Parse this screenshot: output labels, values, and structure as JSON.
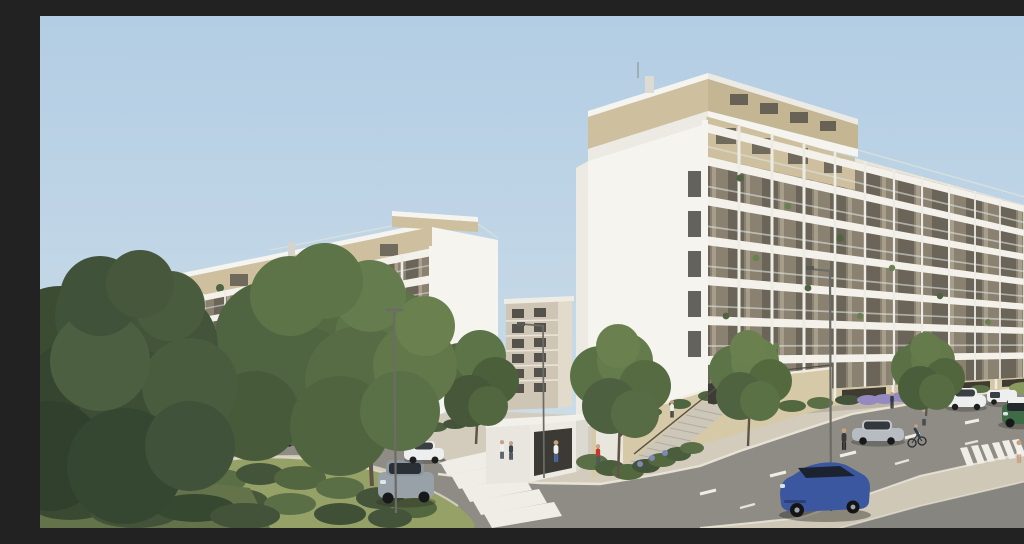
{
  "meta": {
    "title": "New-build residential complex — exterior street rendering",
    "description": "Photorealistic architectural 3D visualization: two white mid-rise apartment blocks with stacked balcony grids and beige stone attic levels, a curving local street with angled parking around a planted island, a main avenue with dashed lane markings, zebra crossings, street lamps, parked and moving cars, pedestrians, cyclists and young street trees under a clear pale-blue sky.",
    "canvas": {
      "width": 1024,
      "height": 512
    },
    "time_of_day": "day, clear sky",
    "style": "photorealistic CGI exterior view"
  },
  "palette": {
    "sky_top": "#b3cde4",
    "sky_horizon": "#dbe5e4",
    "white_sunlit": "#f5f4ef",
    "white_mid": "#eceae3",
    "white_shade": "#dedbd2",
    "slab_white": "#f3f1ea",
    "pillar_white": "#ecebe4",
    "recess_tan": "#8a8171",
    "recess_dark": "#57524a",
    "glass_dark": "#494741",
    "stone_attic": "#cec09f",
    "stone_base": "#d3c7a4",
    "stone_wall": "#d6c9a8",
    "railing_glass": "#dce3dc",
    "road": "#8e8c85",
    "median": "#cfc8b7",
    "sidewalk": "#d3ccbc",
    "kerb": "#eae5d8",
    "marking": "#efede5",
    "grass": "#96a168",
    "grass_shade": "#64734a",
    "bush_dark": "#44543a",
    "bush_mid": "#5a6f45",
    "leaf_dark": "#3c4c32",
    "leaf_mid": "#4f6440",
    "leaf_light": "#69804f",
    "distant_green": "#74855c",
    "lavender": "#9589c0",
    "flower_blue": "#7f86b8",
    "trunk": "#5f5546",
    "lamp": "#6c6c66",
    "umbrella": "#d9c298",
    "car_white": "#edefee",
    "car_black": "#33353a",
    "car_gray": "#4e5256",
    "car_silver": "#b6bcc1",
    "car_steel": "#99a1a8",
    "car_blue": "#3a57a0",
    "car_green": "#3f6b46",
    "skin": "#c8a084"
  },
  "scene": {
    "sky": {
      "condition": "clear",
      "gradient": [
        "sky_top",
        "sky_horizon"
      ]
    },
    "buildings": [
      {
        "id": "left-apartment-block",
        "floors_visible": 7,
        "penthouse": "recessed beige stone attic level with roof-terrace glass railing and planting",
        "facade": "white concrete balcony grid, glass balustrades, planted balconies",
        "ground_floor": "full-height dark glazing between white piers",
        "orientation": "long facade receding toward the left, white gable end at right"
      },
      {
        "id": "right-apartment-block",
        "floors_visible": 8,
        "penthouse": "beige travertine attic band with clerestory windows",
        "facade": "white balcony grid with glass balustrades and balcony planting, receding to the right",
        "gable": "large blank white end wall with slot windows at the corner",
        "base": "travertine stone plinth with dark glazed openings"
      },
      {
        "id": "background-tower",
        "floors_visible": 7,
        "facade": "beige facade with dark window grid, seen in the gap between the two main blocks"
      }
    ],
    "street": {
      "roads": [
        {
          "id": "main-avenue",
          "markings": "white dashed lane lines",
          "median": "paved median strip with second carriageway at corner"
        },
        {
          "id": "local-loop-street",
          "feature": "curves around a planted island, parallel parking along the kerb"
        }
      ],
      "crosswalks": 2,
      "street_lamps": 4,
      "landscaping": [
        "two mature foreground trees",
        "planted traffic island with shrubs",
        "young street trees",
        "lavender beds",
        "flowering groundcover at the corner"
      ]
    },
    "structures": [
      {
        "id": "garage-kiosk",
        "desc": "small flat-roofed white utility building with dark opening"
      },
      {
        "id": "entrance-stairs",
        "desc": "stone-flanked exterior stair with metal handrail up to the podium entrance"
      },
      {
        "id": "retaining-wall",
        "desc": "travertine planter wall with overhanging greenery"
      },
      {
        "id": "parasol",
        "desc": "beige patio umbrella on the podium terrace"
      }
    ],
    "vehicles": [
      {
        "id": "hatchback-far-left",
        "type": "hatchback",
        "color": "#edefee",
        "color_name": "white",
        "state": "parked"
      },
      {
        "id": "sedan-behind-tree",
        "type": "sedan",
        "color": "#33353a",
        "color_name": "black",
        "state": "parked"
      },
      {
        "id": "hatchback-left-1",
        "type": "hatchback",
        "color": "#edefee",
        "color_name": "white",
        "state": "parked"
      },
      {
        "id": "suv-left-black",
        "type": "SUV",
        "color": "#33353a",
        "color_name": "black",
        "state": "parked"
      },
      {
        "id": "hatchback-left-2",
        "type": "hatchback",
        "color": "#edefee",
        "color_name": "white",
        "state": "parked"
      },
      {
        "id": "estate-left-gray",
        "type": "estate",
        "color": "#4e5256",
        "color_name": "dark gray",
        "state": "parked"
      },
      {
        "id": "hatchback-driving-silver",
        "type": "hatchback",
        "color": "#99a1a8",
        "color_name": "silver gray",
        "state": "driving"
      },
      {
        "id": "hatchback-crosswalk-white",
        "type": "hatchback",
        "color": "#edefee",
        "color_name": "white",
        "state": "parked"
      },
      {
        "id": "sedan-right-silver",
        "type": "sedan",
        "color": "#b6bcc1",
        "color_name": "silver",
        "state": "parked"
      },
      {
        "id": "suv-right-white",
        "type": "SUV",
        "color": "#edefee",
        "color_name": "white",
        "state": "parked"
      },
      {
        "id": "van-right-white",
        "type": "van",
        "color": "#edefee",
        "color_name": "white",
        "state": "parked"
      },
      {
        "id": "crossover-green",
        "type": "compact crossover",
        "color": "#3f6b46",
        "color_name": "green with white roof",
        "state": "driving"
      },
      {
        "id": "suv-coupe-blue",
        "type": "SUV coupe",
        "color": "#3a57a0",
        "color_name": "blue",
        "state": "driving"
      }
    ],
    "people": [
      {
        "id": "cyclist-island",
        "activity": "cycling around the island bend"
      },
      {
        "id": "cyclist-avenue",
        "activity": "cycling near the avenue crossing"
      },
      {
        "id": "walker-pair-a",
        "activity": "walking along the left block",
        "clothing": "white top"
      },
      {
        "id": "walker-pair-b",
        "activity": "walking along the left block",
        "clothing": "dark top"
      },
      {
        "id": "man-white-shirt",
        "activity": "strolling on the corner pavement",
        "clothing": "white shirt, jeans"
      },
      {
        "id": "person-on-stairs",
        "activity": "climbing the entrance stairs",
        "clothing": "white top, dark shorts"
      },
      {
        "id": "person-red-top",
        "activity": "standing by the planting",
        "clothing": "red top"
      },
      {
        "id": "walker-dark",
        "activity": "crossing the avenue edge",
        "clothing": "dark outfit"
      },
      {
        "id": "walker-gray",
        "activity": "walking on the avenue pavement",
        "clothing": "gray top"
      },
      {
        "id": "woman-white-dress",
        "activity": "walking at far right",
        "clothing": "white top"
      },
      {
        "id": "person-navy-lavender",
        "activity": "standing by the lavender bed",
        "clothing": "navy top"
      }
    ],
    "counts": {
      "vehicles": 13,
      "people": 11,
      "street_trees": 5,
      "foreground_trees": 2
    }
  }
}
